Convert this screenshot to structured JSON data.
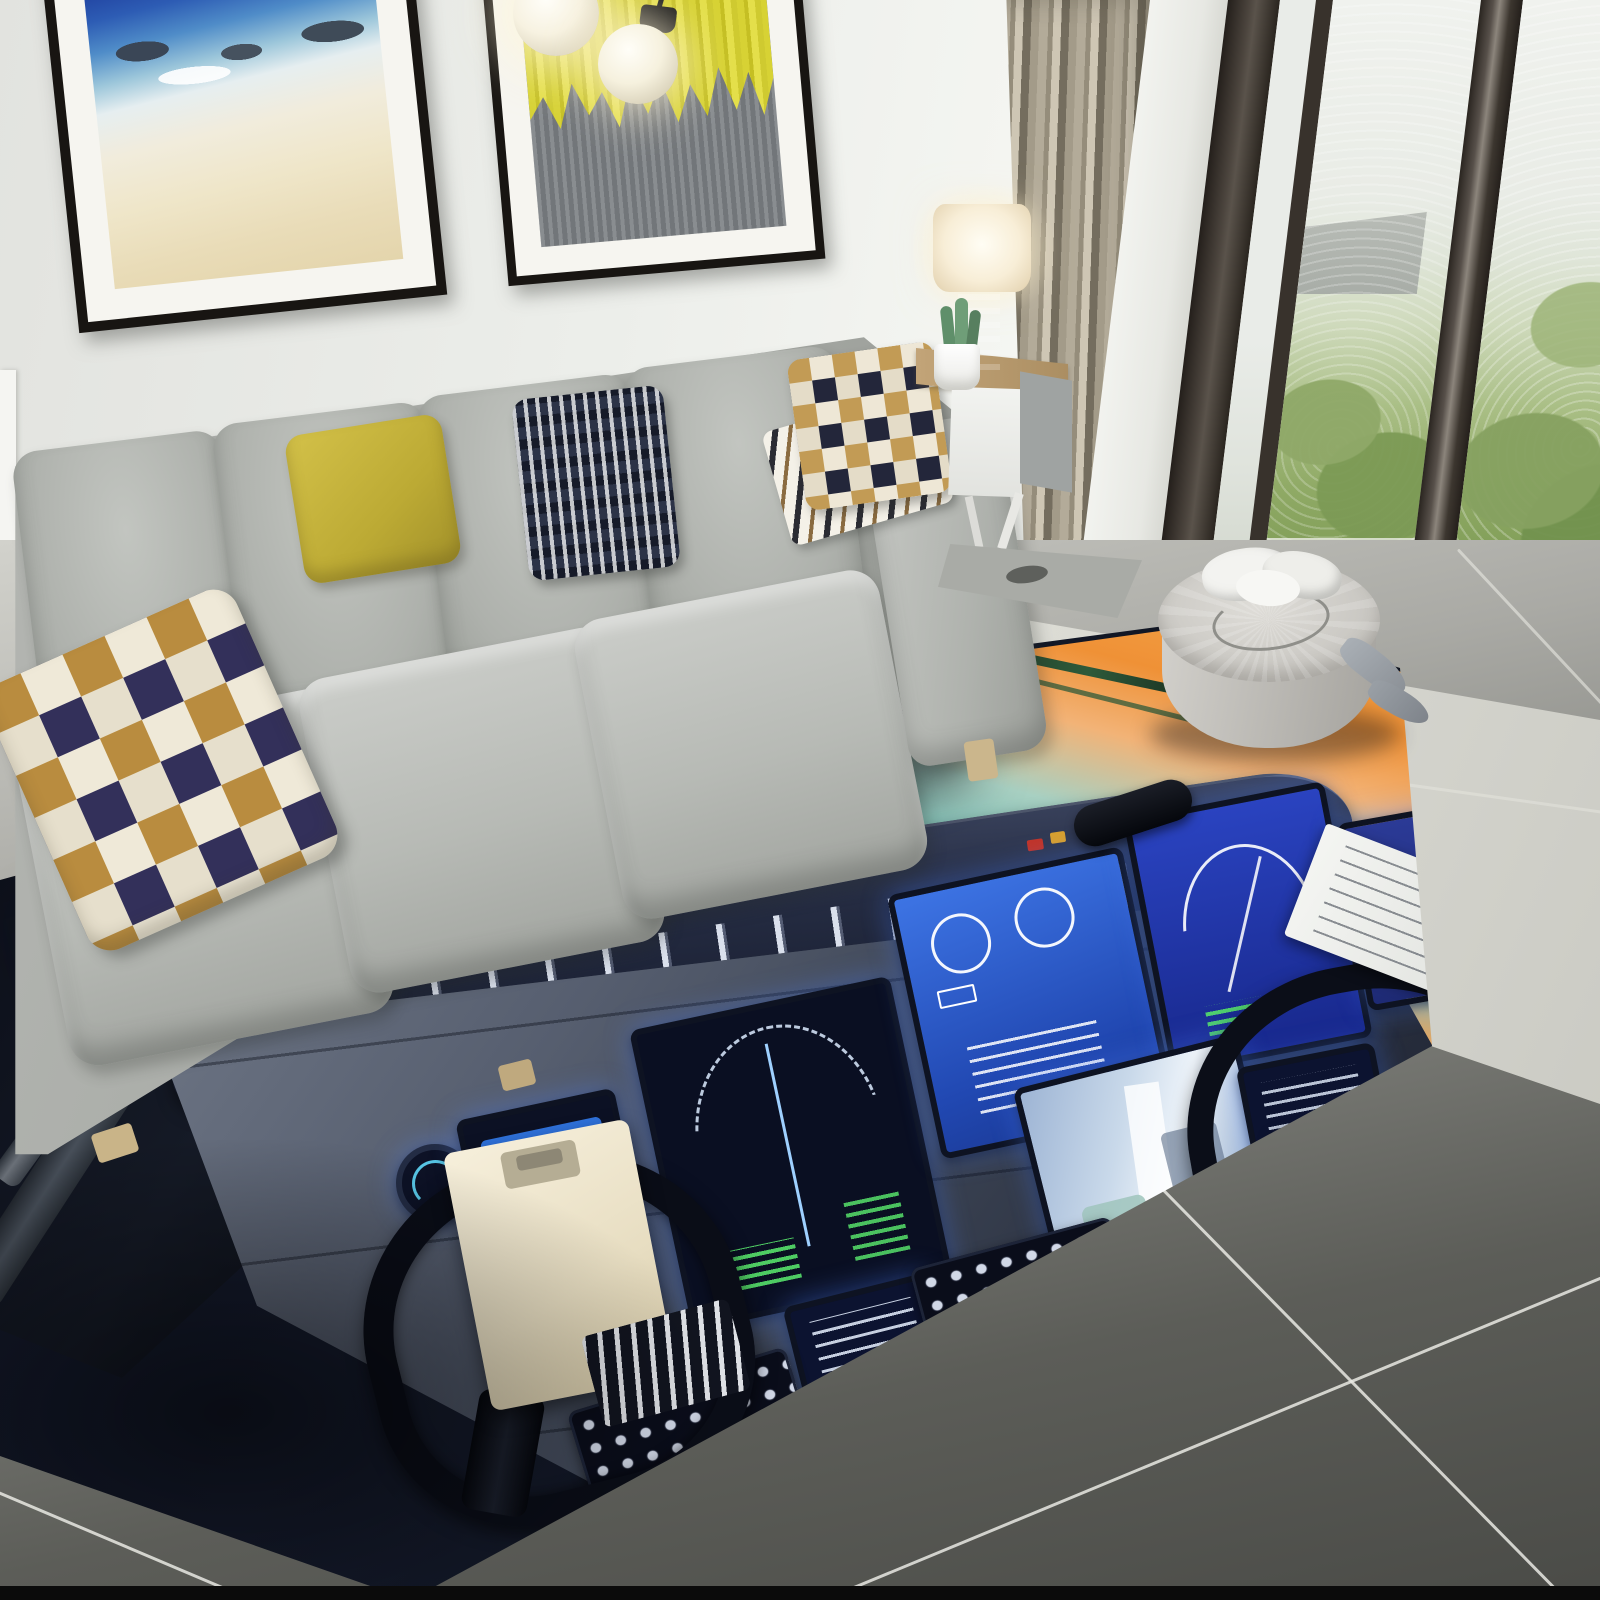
{
  "scene": {
    "type": "photograph",
    "description": "Modern living room with a large 3D-printed airplane cockpit flight-deck area rug",
    "room": {
      "wall_color": "#edeeea",
      "floor": "gray ceramic tiles with light grout, brighter marble near window",
      "bottom_border": "thin black photo edge"
    },
    "wall_art": {
      "left_painting": {
        "name": "framed beach seascape",
        "frame": "#181512",
        "mat": "#f6f5f0",
        "colors": [
          "#16246e",
          "#2d5cb4",
          "#9cc6da",
          "#f1ecdc",
          "#e9dcb8"
        ]
      },
      "right_painting": {
        "name": "framed abstract yellow drip over gray",
        "frame": "#181512",
        "mat": "#f6f5f0",
        "colors": [
          "#d7d234",
          "#7c8084"
        ]
      }
    },
    "pendant_light": {
      "name": "double frosted glass globe pendant",
      "globe_color": "#f6f1de",
      "fitting": "#151515",
      "count": 2
    },
    "sofa": {
      "name": "light gray fabric sofa",
      "fabric": "#b4b6b2",
      "back_cushions": 4,
      "seat_cushions": 3,
      "pillows": [
        {
          "name": "checkered pillow",
          "colors": [
            "#efe9d8",
            "#33305a",
            "#b98c3f"
          ]
        },
        {
          "name": "mustard pillow",
          "colors": [
            "#c9b83e"
          ]
        },
        {
          "name": "navy dash pillow",
          "colors": [
            "#2c3347",
            "#ffffff"
          ]
        },
        {
          "name": "mini checkered pillow with fringe throw",
          "colors": [
            "#ece7da",
            "#1f2230",
            "#c29b55"
          ]
        }
      ],
      "legs": "#c9b488"
    },
    "side_table": {
      "name": "wood top white cabinet side table",
      "top": "#b89a6e",
      "front": "#f0f1ee"
    },
    "table_lamp": {
      "name": "cylinder shade table lamp",
      "shade": "#f9f1dd",
      "base": "#b0a68d",
      "state": "on"
    },
    "plant": {
      "name": "cactus in white pot",
      "pot": "#f2f2ee",
      "leaves": "#6f9e78"
    },
    "curtain": {
      "name": "pleated taupe curtain",
      "colors": [
        "#b3ab99",
        "#746d5e",
        "#cec6b4"
      ]
    },
    "window": {
      "name": "floor to ceiling glazing",
      "frame": "#3f3a35",
      "view": [
        "hazy sky",
        "green trees",
        "balcony floor"
      ]
    },
    "pouf": {
      "name": "round gray pouf",
      "body": "#c4c2bd",
      "items_on_top": [
        "white crumpled cloth",
        "thin cord"
      ]
    },
    "slippers": {
      "name": "gray slippers by pouf",
      "color": "#9aa0a6"
    },
    "rug": {
      "name": "airplane cockpit flight deck print rug",
      "base": "#11172a",
      "features": [
        "overhead switch panel",
        "sunset windshield with orange and teal sky",
        "center windshield post",
        "standby compass dome",
        "glareshield autopilot panel with knobs",
        "primary flight display",
        "navigation display arcs",
        "engine EICAS display",
        "cabin camera display",
        "FMC text screens",
        "CDU keypads",
        "two control yokes",
        "cream clipboard on left yoke",
        "white checklist sheet on right yoke",
        "silver toggle switches",
        "red and amber switch accents"
      ],
      "sunset_colors": [
        "#f5a94e",
        "#ef8f33",
        "#7fbfb6",
        "#e0883a"
      ],
      "screen_glow": "#2e64d4"
    },
    "palette": {
      "wall": "#edeeea",
      "sofa_gray": "#b4b6b2",
      "rug_navy": "#11172a",
      "sunset_orange": "#ef9136",
      "sky_teal": "#7fbfb6",
      "display_blue": "#2e64d4",
      "tile_dark": "#55564f",
      "marble_light": "#efefe9",
      "accent_yellow": "#c9b83e"
    }
  }
}
